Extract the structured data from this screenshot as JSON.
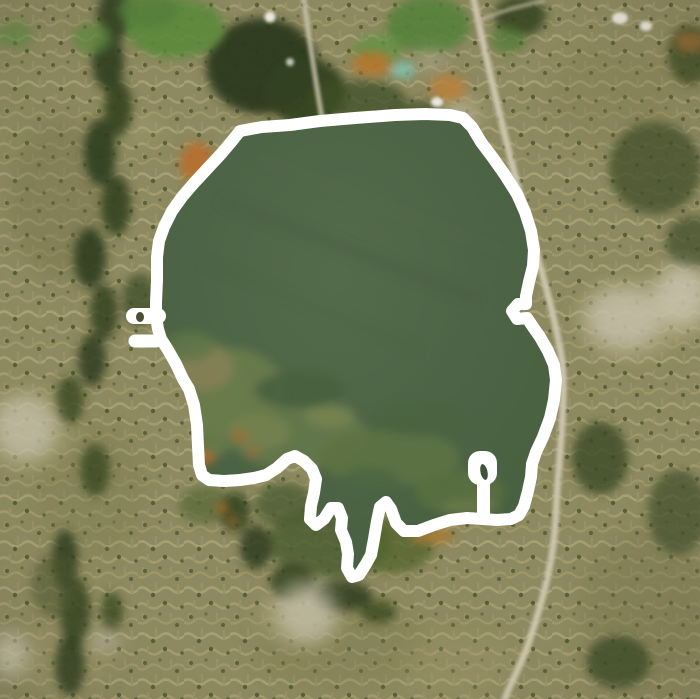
{
  "view": {
    "kind": "satellite-map",
    "description": "Aerial satellite imagery of a suburban area with a large lake; a thick white hand-traced outline annotation encircles the lake shoreline, with two small flag-like annotation glyphs on the west shore and near the south-east shore."
  },
  "palette": {
    "water": "#4d6345",
    "water_deep": "#46603e",
    "water_light": "#546b4b",
    "suburb_base": "#8d8960",
    "forest_dark": "#2e3d1d",
    "forest_mid": "#44522c",
    "field_green": "#5b8a3c",
    "road_tan": "#c9c2a8",
    "orange_soil": "#b5772f",
    "pond_teal": "#7fbfa9",
    "building_white": "#e9e7de",
    "annotation": "#ffffff"
  },
  "annotation": {
    "stroke_color": "#ffffff",
    "stroke_width": 12,
    "outline_points": [
      [
        240,
        131
      ],
      [
        262,
        127
      ],
      [
        290,
        125
      ],
      [
        320,
        121
      ],
      [
        355,
        118
      ],
      [
        395,
        115
      ],
      [
        425,
        114
      ],
      [
        450,
        115
      ],
      [
        463,
        118
      ],
      [
        472,
        127
      ],
      [
        481,
        142
      ],
      [
        493,
        158
      ],
      [
        505,
        175
      ],
      [
        517,
        194
      ],
      [
        525,
        212
      ],
      [
        531,
        231
      ],
      [
        534,
        250
      ],
      [
        533,
        266
      ],
      [
        529,
        282
      ],
      [
        526,
        296
      ],
      [
        526,
        304
      ],
      [
        518,
        304
      ],
      [
        512,
        311
      ],
      [
        517,
        319
      ],
      [
        527,
        318
      ],
      [
        533,
        327
      ],
      [
        540,
        337
      ],
      [
        548,
        351
      ],
      [
        554,
        365
      ],
      [
        556,
        380
      ],
      [
        554,
        400
      ],
      [
        550,
        418
      ],
      [
        543,
        437
      ],
      [
        536,
        452
      ],
      [
        532,
        464
      ],
      [
        531,
        477
      ],
      [
        528,
        491
      ],
      [
        524,
        506
      ],
      [
        519,
        515
      ],
      [
        511,
        519
      ],
      [
        497,
        520
      ],
      [
        483,
        519
      ],
      [
        467,
        518
      ],
      [
        450,
        520
      ],
      [
        434,
        525
      ],
      [
        418,
        531
      ],
      [
        404,
        531
      ],
      [
        396,
        523
      ],
      [
        391,
        509
      ],
      [
        386,
        502
      ],
      [
        380,
        507
      ],
      [
        377,
        521
      ],
      [
        374,
        539
      ],
      [
        371,
        555
      ],
      [
        366,
        564
      ],
      [
        359,
        575
      ],
      [
        352,
        577
      ],
      [
        347,
        568
      ],
      [
        348,
        554
      ],
      [
        346,
        542
      ],
      [
        341,
        530
      ],
      [
        342,
        518
      ],
      [
        338,
        508
      ],
      [
        331,
        508
      ],
      [
        324,
        519
      ],
      [
        316,
        525
      ],
      [
        310,
        519
      ],
      [
        311,
        506
      ],
      [
        314,
        493
      ],
      [
        316,
        479
      ],
      [
        312,
        469
      ],
      [
        304,
        461
      ],
      [
        295,
        456
      ],
      [
        287,
        459
      ],
      [
        277,
        468
      ],
      [
        266,
        475
      ],
      [
        254,
        478
      ],
      [
        240,
        480
      ],
      [
        224,
        481
      ],
      [
        209,
        480
      ],
      [
        202,
        475
      ],
      [
        199,
        465
      ],
      [
        198,
        446
      ],
      [
        197,
        425
      ],
      [
        194,
        405
      ],
      [
        189,
        389
      ],
      [
        183,
        379
      ],
      [
        176,
        364
      ],
      [
        168,
        350
      ],
      [
        161,
        339
      ],
      [
        158,
        329
      ],
      [
        156,
        316
      ],
      [
        156,
        302
      ],
      [
        157,
        280
      ],
      [
        157,
        257
      ],
      [
        159,
        241
      ],
      [
        164,
        227
      ],
      [
        172,
        211
      ],
      [
        182,
        197
      ],
      [
        194,
        183
      ],
      [
        207,
        169
      ],
      [
        221,
        154
      ],
      [
        232,
        141
      ]
    ],
    "markers": {
      "left_flag": {
        "bars": [
          {
            "x1": 158,
            "y1": 316,
            "x2": 134,
            "y2": 316,
            "w": 16
          },
          {
            "x1": 156,
            "y1": 341,
            "x2": 135,
            "y2": 341,
            "w": 13
          }
        ],
        "hole": {
          "cx": 140,
          "cy": 317,
          "rx": 4,
          "ry": 5,
          "fill": "#4a4f2e"
        }
      },
      "right_flag": {
        "head": {
          "x": 468,
          "y": 451,
          "w": 29,
          "h": 34,
          "rx": 12
        },
        "stem": {
          "x": 477,
          "y": 477,
          "w": 13,
          "h": 45,
          "rx": 5
        },
        "hole": {
          "cx": 484,
          "cy": 472,
          "rx": 3.5,
          "ry": 8,
          "fill": "#41543a"
        }
      }
    }
  }
}
